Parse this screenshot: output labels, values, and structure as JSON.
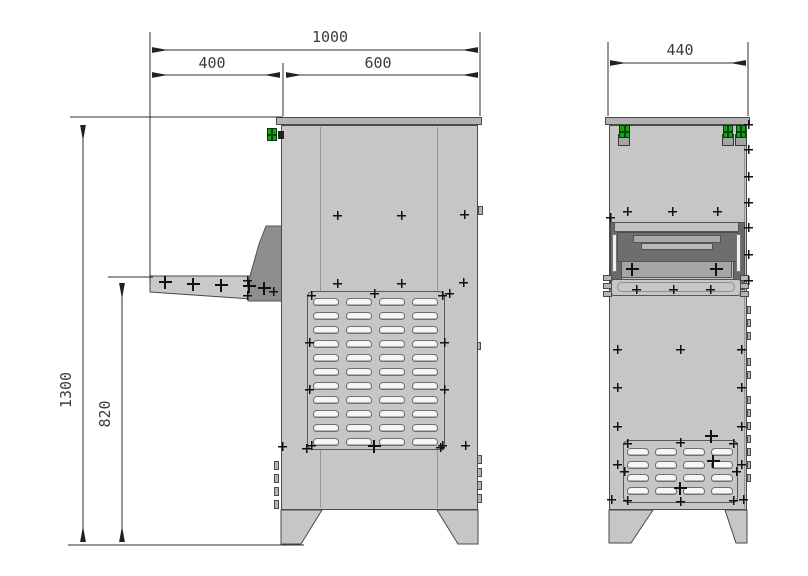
{
  "drawing": {
    "type": "technical-dimension-drawing",
    "views": [
      {
        "name": "side view with feeding shelf"
      },
      {
        "name": "front view with outlet opening"
      }
    ],
    "dimensions": {
      "total_width": "1000",
      "shelf_depth": "400",
      "body_depth": "600",
      "front_width": "440",
      "total_height": "1300",
      "shelf_height": "820"
    },
    "vents": {
      "side": {
        "rows": 11,
        "cols": 4
      },
      "front": {
        "rows": 4,
        "cols": 4
      }
    },
    "colors": {
      "body": "#c6c6c6",
      "cap": "#b3b3b3",
      "cavity": "#6e6e6e",
      "bracket": "#8e8e8e",
      "shelf": "#c9c9c9",
      "accent_green": "#17a317",
      "line": "#2f2f2f"
    }
  }
}
